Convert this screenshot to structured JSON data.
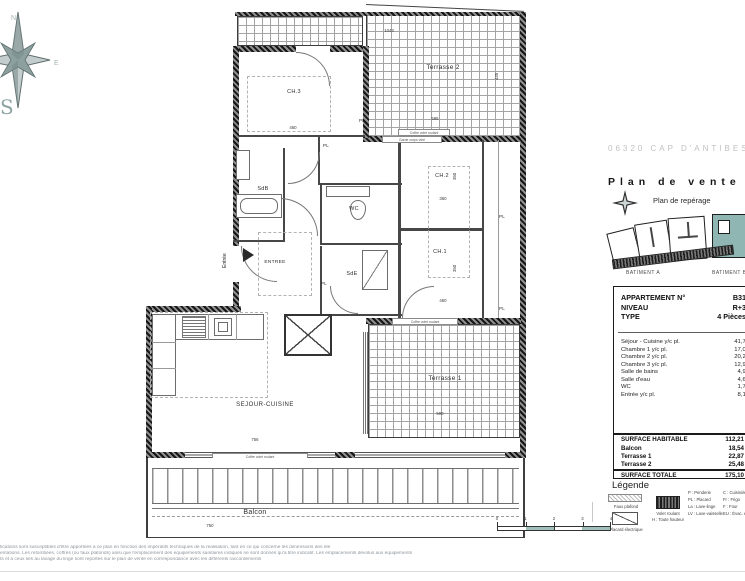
{
  "title_block": {
    "location": "06320 CAP D'ANTIBES",
    "doc_title": "Plan de vente",
    "subtitle": "Plan de repérage",
    "batiment_a": "BATIMENT A",
    "batiment_b": "BATIMENT B"
  },
  "apartment": {
    "labels": {
      "num_label": "APPARTEMENT N°",
      "niveau_label": "NIVEAU",
      "type_label": "TYPE"
    },
    "values": {
      "num": "B31",
      "niveau": "R+3",
      "type": "4 Pièces"
    },
    "rooms": [
      {
        "name": "Séjour - Cuisine y/c pl.",
        "area": "41,70"
      },
      {
        "name": "Chambre 1 y/c pl.",
        "area": "17,03"
      },
      {
        "name": "Chambre 2 y/c pl.",
        "area": "20,29"
      },
      {
        "name": "Chambre 3 y/c pl.",
        "area": "12,94"
      },
      {
        "name": "Salle de bains",
        "area": "4,95"
      },
      {
        "name": "Salle d'eau",
        "area": "4,68"
      },
      {
        "name": "WC",
        "area": "1,70"
      },
      {
        "name": "Entrée y/c pl.",
        "area": "8,10"
      }
    ],
    "totals": [
      {
        "name": "SURFACE HABITABLE",
        "area": "112,21"
      },
      {
        "name": "Balcon",
        "area": "18,54"
      },
      {
        "name": "Terrasse 1",
        "area": "22,87"
      },
      {
        "name": "Terrasse 2",
        "area": "25,48"
      },
      {
        "name": "SURFACE TOTALE",
        "area": "175,10"
      }
    ]
  },
  "legend": {
    "title": "Légende",
    "sym_faux_plafond": "Faux plafond",
    "sym_placard_elec": "Placard électrique",
    "sym_volet": "Volet roulant",
    "sym_volet2": "H : Toute hauteur",
    "col_a": [
      "P : Penderie",
      "PL : Placard",
      "La : Lave-linge",
      "LV : Lave-vaisselle"
    ],
    "col_b": [
      "C : Cuisinière",
      "Fr : Frigo",
      "F : Four",
      "EU : Évac. eaux usées"
    ]
  },
  "plan": {
    "rooms": {
      "ch3": "CH.3",
      "terrasse2": "Terrasse 2",
      "sdb": "SdB",
      "wc": "WC",
      "ch2": "CH.2",
      "ch1": "CH.1",
      "sde": "SdE",
      "entree_hall": "ENTREE",
      "entree": "Entrée",
      "sejour": "SEJOUR-CUISINE",
      "terrasse1": "Terrasse 1",
      "balcon": "Balcon",
      "pl": "PL"
    },
    "dims": {
      "ch3_w": "460",
      "terr2_top": "1043",
      "terr2_w": "595",
      "terr2_h": "445",
      "ch2_w": "360",
      "ch1_w": "460",
      "ch_h": "350",
      "sejour_w": "756",
      "terr1_w": "590",
      "balcon_w": "750"
    },
    "strips": {
      "coffre": "Coffre volet roulant",
      "garde": "Garde corps vitré"
    }
  },
  "compass": {
    "n": "N",
    "e": "E",
    "s": "S"
  },
  "scalebar": {
    "ticks": [
      "0",
      "1",
      "2",
      "3",
      "4"
    ]
  },
  "disclaimer": {
    "lines": [
      "fications sont susceptibles d'être apportées à ce plan en fonction des impératifs techniques de la réalisation, tant en ce qui concerne les dimensions des élé",
      "entations. Les retombées, coffres (ou faux plafonds) ainsi que l'emplacement des équipements sanitaires indiqués ne sont donnés qu'à titre indicatif. Les emplacements dévolus aux équipements",
      "ts et à ceux liés au lavage du linge sont reportés sur le plan de vente en correspondance avec les différents raccordements"
    ]
  }
}
